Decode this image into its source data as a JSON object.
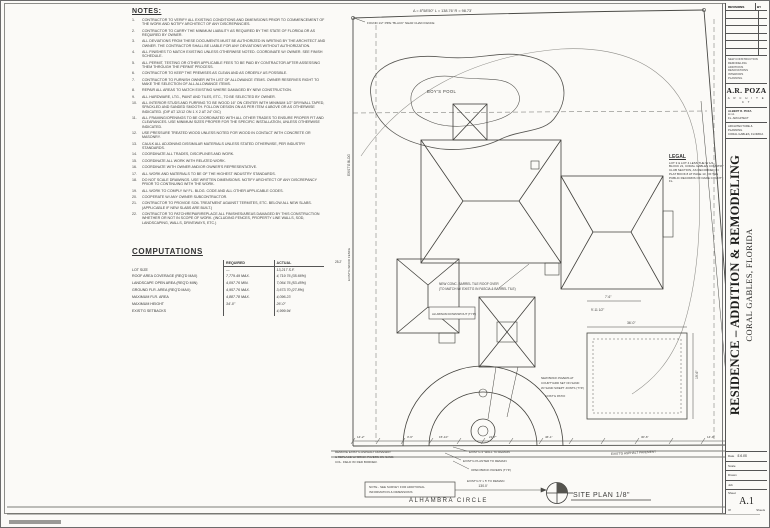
{
  "notes": {
    "title": "NOTES:",
    "items": [
      "CONTRACTOR TO VERIFY ALL EXISTING CONDITIONS AND DIMENSIONS PRIOR TO COMMENCEMENT OF THE WORK AND NOTIFY ARCHITECT OF ANY DISCREPANCIES.",
      "CONTRACTOR TO CARRY THE MINIMUM LIABILITY AS REQUIRED BY THE STATE OF FLORIDA OR AS REQUIRED BY OWNER.",
      "ALL DEVIATIONS FROM THESE DOCUMENTS MUST BE AUTHORIZED IN WRITING BY THE ARCHITECT AND OWNER. THE CONTRACTOR SHALL BE LIABLE FOR ANY DEVIATIONS WITHOUT AUTHORIZATION.",
      "ALL FINISHES TO MATCH EXISTING UNLESS OTHERWISE NOTED. COORDINATE W/ OWNER. SEE FINISH SCHEDULE.",
      "ALL PERMIT, TESTING OR OTHER APPLICABLE FEES TO BE PAID BY CONTRACTOR AFTER ASSESSING THEM THROUGH THE PERMIT PROCESS.",
      "CONTRACTOR TO KEEP THE PREMISES AS CLEAN AND AS ORDERLY AS POSSIBLE.",
      "CONTRACTOR TO FURNISH OWNER WITH LIST OF ALLOWANCE ITEMS. OWNER RESERVES RIGHT TO MAKE THE SELECTION OF ALL ALLOWANCE ITEMS.",
      "REPAIR ALL AREAS TO MATCH EXISTING WHERE DAMAGED BY NEW CONSTRUCTION.",
      "ALL HARDWARE, LTG., PAINT AND TILES, ETC., TO BE SELECTED BY OWNER.",
      "ALL INTERIOR STUDS AND FURRING TO BE WOOD 16\" ON CENTER WITH MINIMUM 1/2\" DRYWALL TAPED, SPACKLED AND SANDED SMOOTH. FOLLOW DESIGN ON AS PER ITEM 4 ABOVE OR AS OTHERWISE INDICATED. (DIF AT 12/12 ON 1 X 2 AT 24\" O/C)",
      "ALL FRAMING/OPENINGS TO BE COORDINATED WITH ALL OTHER TRADES TO ENSURE PROPER FIT AND CLEARANCES. USE MINIMUM SIZES PROPER FOR THE SPECIFIC INSTALLATION, UNLESS OTHERWISE INDICATED.",
      "USE PRESSURE TREATED WOOD UNLESS NOTED FOR WOOD IN CONTACT WITH CONCRETE OR MASONRY.",
      "CAULK ALL ADJOINING DISSIMILAR MATERIALS UNLESS STATED OTHERWISE, PER INDUSTRY STANDARDS.",
      "COORDINATE ALL TRADES, DISCIPLINES AND WORK.",
      "COORDINATE ALL WORK WITH RELATED WORK.",
      "COORDINATE WITH OWNER AND/OR OWNER'S REPRESENTATIVE.",
      "ALL WORK AND MATERIALS TO BE OF THE HIGHEST INDUSTRY STANDARDS.",
      "DO NOT SCALE DRAWINGS. USE WRITTEN DIMENSIONS. NOTIFY ARCHITECT OF ANY DISCREPANCY PRIOR TO CONTINUING WITH THE WORK.",
      "ALL WORK TO COMPLY W/ FL. BLDG. CODE AND ALL OTHER APPLICABLE CODES.",
      "COOPERATE W/ ANY OWNER SUBCONTRACTOR.",
      "CONTRACTOR TO PROVIDE SOIL TREATMENT AGAINST TERMITES, ETC. BELOW ALL NEW SLABS. (APPLICABLE IF NEW SLABS ARE BUILT.)",
      "CONTRACTOR TO PATCH/REPAIR/REPLACE ALL FINISHES/AREAS DAMAGED BY THIS CONSTRUCTION WHETHER OR NOT IN SCOPE OF WORK. (INCLUDING FENCES, PROPERTY LINE WALLS, SOD, LANDSCAPING, WALLS, DRIVEWAYS, ETC.)"
    ]
  },
  "computations": {
    "title": "COMPUTATIONS",
    "col_required": "REQUIRED",
    "col_actual": "ACTUAL",
    "rows": [
      {
        "label": "LOT SIZE",
        "required": "—",
        "actual": "13,217 S.F."
      },
      {
        "label": "ROOF AREA COVERAGE (REQ'D MAX)",
        "required": "7,779.49 MAX.",
        "actual": "4,719.76 (35.66%)"
      },
      {
        "label": "LANDSCAPE OPEN AREA (REQ'D MIN)",
        "required": "4,097.76 MIN.",
        "actual": "7,064.76 (53.45%)"
      },
      {
        "label": "GROUND FLR. AREA (REQ'D MAX)",
        "required": "4,957.76 MAX.",
        "actual": "3,673.70 (27.8%)"
      },
      {
        "label": "MAXIMUM FLR. AREA",
        "required": "4,887.78 MAX.",
        "actual": "4,096.23"
      },
      {
        "label": "MAXIMUM HEIGHT",
        "required": "34'-0\"",
        "actual": "26'-0\""
      },
      {
        "label": "EXIST'G SETBACKS",
        "required": "",
        "actual": "4,999.94"
      }
    ]
  },
  "legal": {
    "title": "LEGAL",
    "text": "LOT 3 & LOT 4 LESS THE W 1/2, BLOCK 21, CORAL GABLES COUNTRY CLUB SECTION, AS RECORDED IN PLAT BOOK 8 AT PAGE 13, OF THE PUBLIC RECORDS OF DADE COUNTY, FL."
  },
  "title_block": {
    "revisions_label": "REVISIONS",
    "by_label": "BY",
    "services": [
      "NEW CONSTRUCTION",
      "REMODELING",
      "ADDITIONS",
      "RENOVATIONS",
      "INTERIORS",
      "PLANNING"
    ],
    "firm_name": "A.R. POZA",
    "firm_title": "A R C H I T E C T",
    "principal_line1": "ALBERT R. POZA",
    "principal_line2": "A.I.A.",
    "principal_line3": "FL. ARCHITECT",
    "office_line1": "ARCHITECTURE & PLANNING",
    "office_line2": "CORAL GABLES, FLORIDA"
  },
  "project": {
    "title": "RESIDENCE – ADDITION & REMODELING",
    "subtitle": "CORAL GABLES, FLORIDA"
  },
  "sheet_info": {
    "date_label": "Date",
    "date_value": "5.6.05",
    "scale_label": "Scale",
    "scale_value": "",
    "drawn_label": "Drawn",
    "drawn_value": "",
    "job_label": "Job",
    "job_value": "",
    "sheet_label": "Sheet",
    "sheet_number": "A.1",
    "of_label": "Of",
    "sheets_label": "Sheets"
  },
  "plan": {
    "curve_data": "Δ = 8°58'50\"    L = 138.76'    R = 98.73'",
    "monument_note": "FOUND 1/2\" PIPE \"BLACK\" NEAR CHAIN FENCE",
    "pond_label": "BOY'S POOL",
    "exist_bldg_label": "EXIST'G BLDG",
    "fence_label": "EXIST'G WOOD FENCE",
    "left_dim": "25.2'",
    "roof_note_1": "NEW CONC. BARREL TILE ROOF OVER",
    "roof_note_2": "(TO MATCH W/ EXIST'G IN FASCIA & BARREL TILE)",
    "downspout_note": "ALUMINUM DOWNSPOUT (TYP.)",
    "courtyard_note_1": "NEW BRICK PAVERS AT",
    "courtyard_note_2": "COURTYARD SET ON SAND",
    "courtyard_note_3": "W/ SAND SWEPT JOINTS (TYP.)",
    "patio_label": "EXIST'G PATIO",
    "dim_36": "36'-0\"",
    "dim_19_6": "19'-6\"",
    "dim_7_6": "7'-6\"",
    "dim_9_11": "9'-11 1/2\"",
    "driveway_note_1": "REMOVE EXIST'G ASPHALT DRIVEWAY",
    "driveway_note_2": "& REPLACE W/ BRICK PAVERS ON SAND.",
    "driveway_note_3": "COL. FIELD W/ RED BORDER.",
    "wall_note": "EXIST'G 4' WALL TO REMAIN",
    "planter_note": "EXIST'G PLANTER TO REMAIN",
    "pavers_note": "OPEN BRICK PAVERS (TYP.)",
    "remain_note": "EXIST'G 5' x 5' TO REMAIN",
    "pavement_note": "EXIST'G ASPHALT PAVEMENT",
    "survey_note_1": "NOTE - SEE SURVEY FOR ADDITIONAL",
    "survey_note_2": "INFORMATION & DIMENSIONS",
    "dim_130": "130.0'",
    "street_name": "ALHAMBRA CIRCLE",
    "plan_title": "SITE PLAN 1/8\"",
    "bottom_dims": [
      "14'-2\"",
      "3'-6\"",
      "15'-10\"",
      "21'-7\"",
      "46'-1\"",
      "30'-6\"",
      "14'-9\""
    ]
  }
}
